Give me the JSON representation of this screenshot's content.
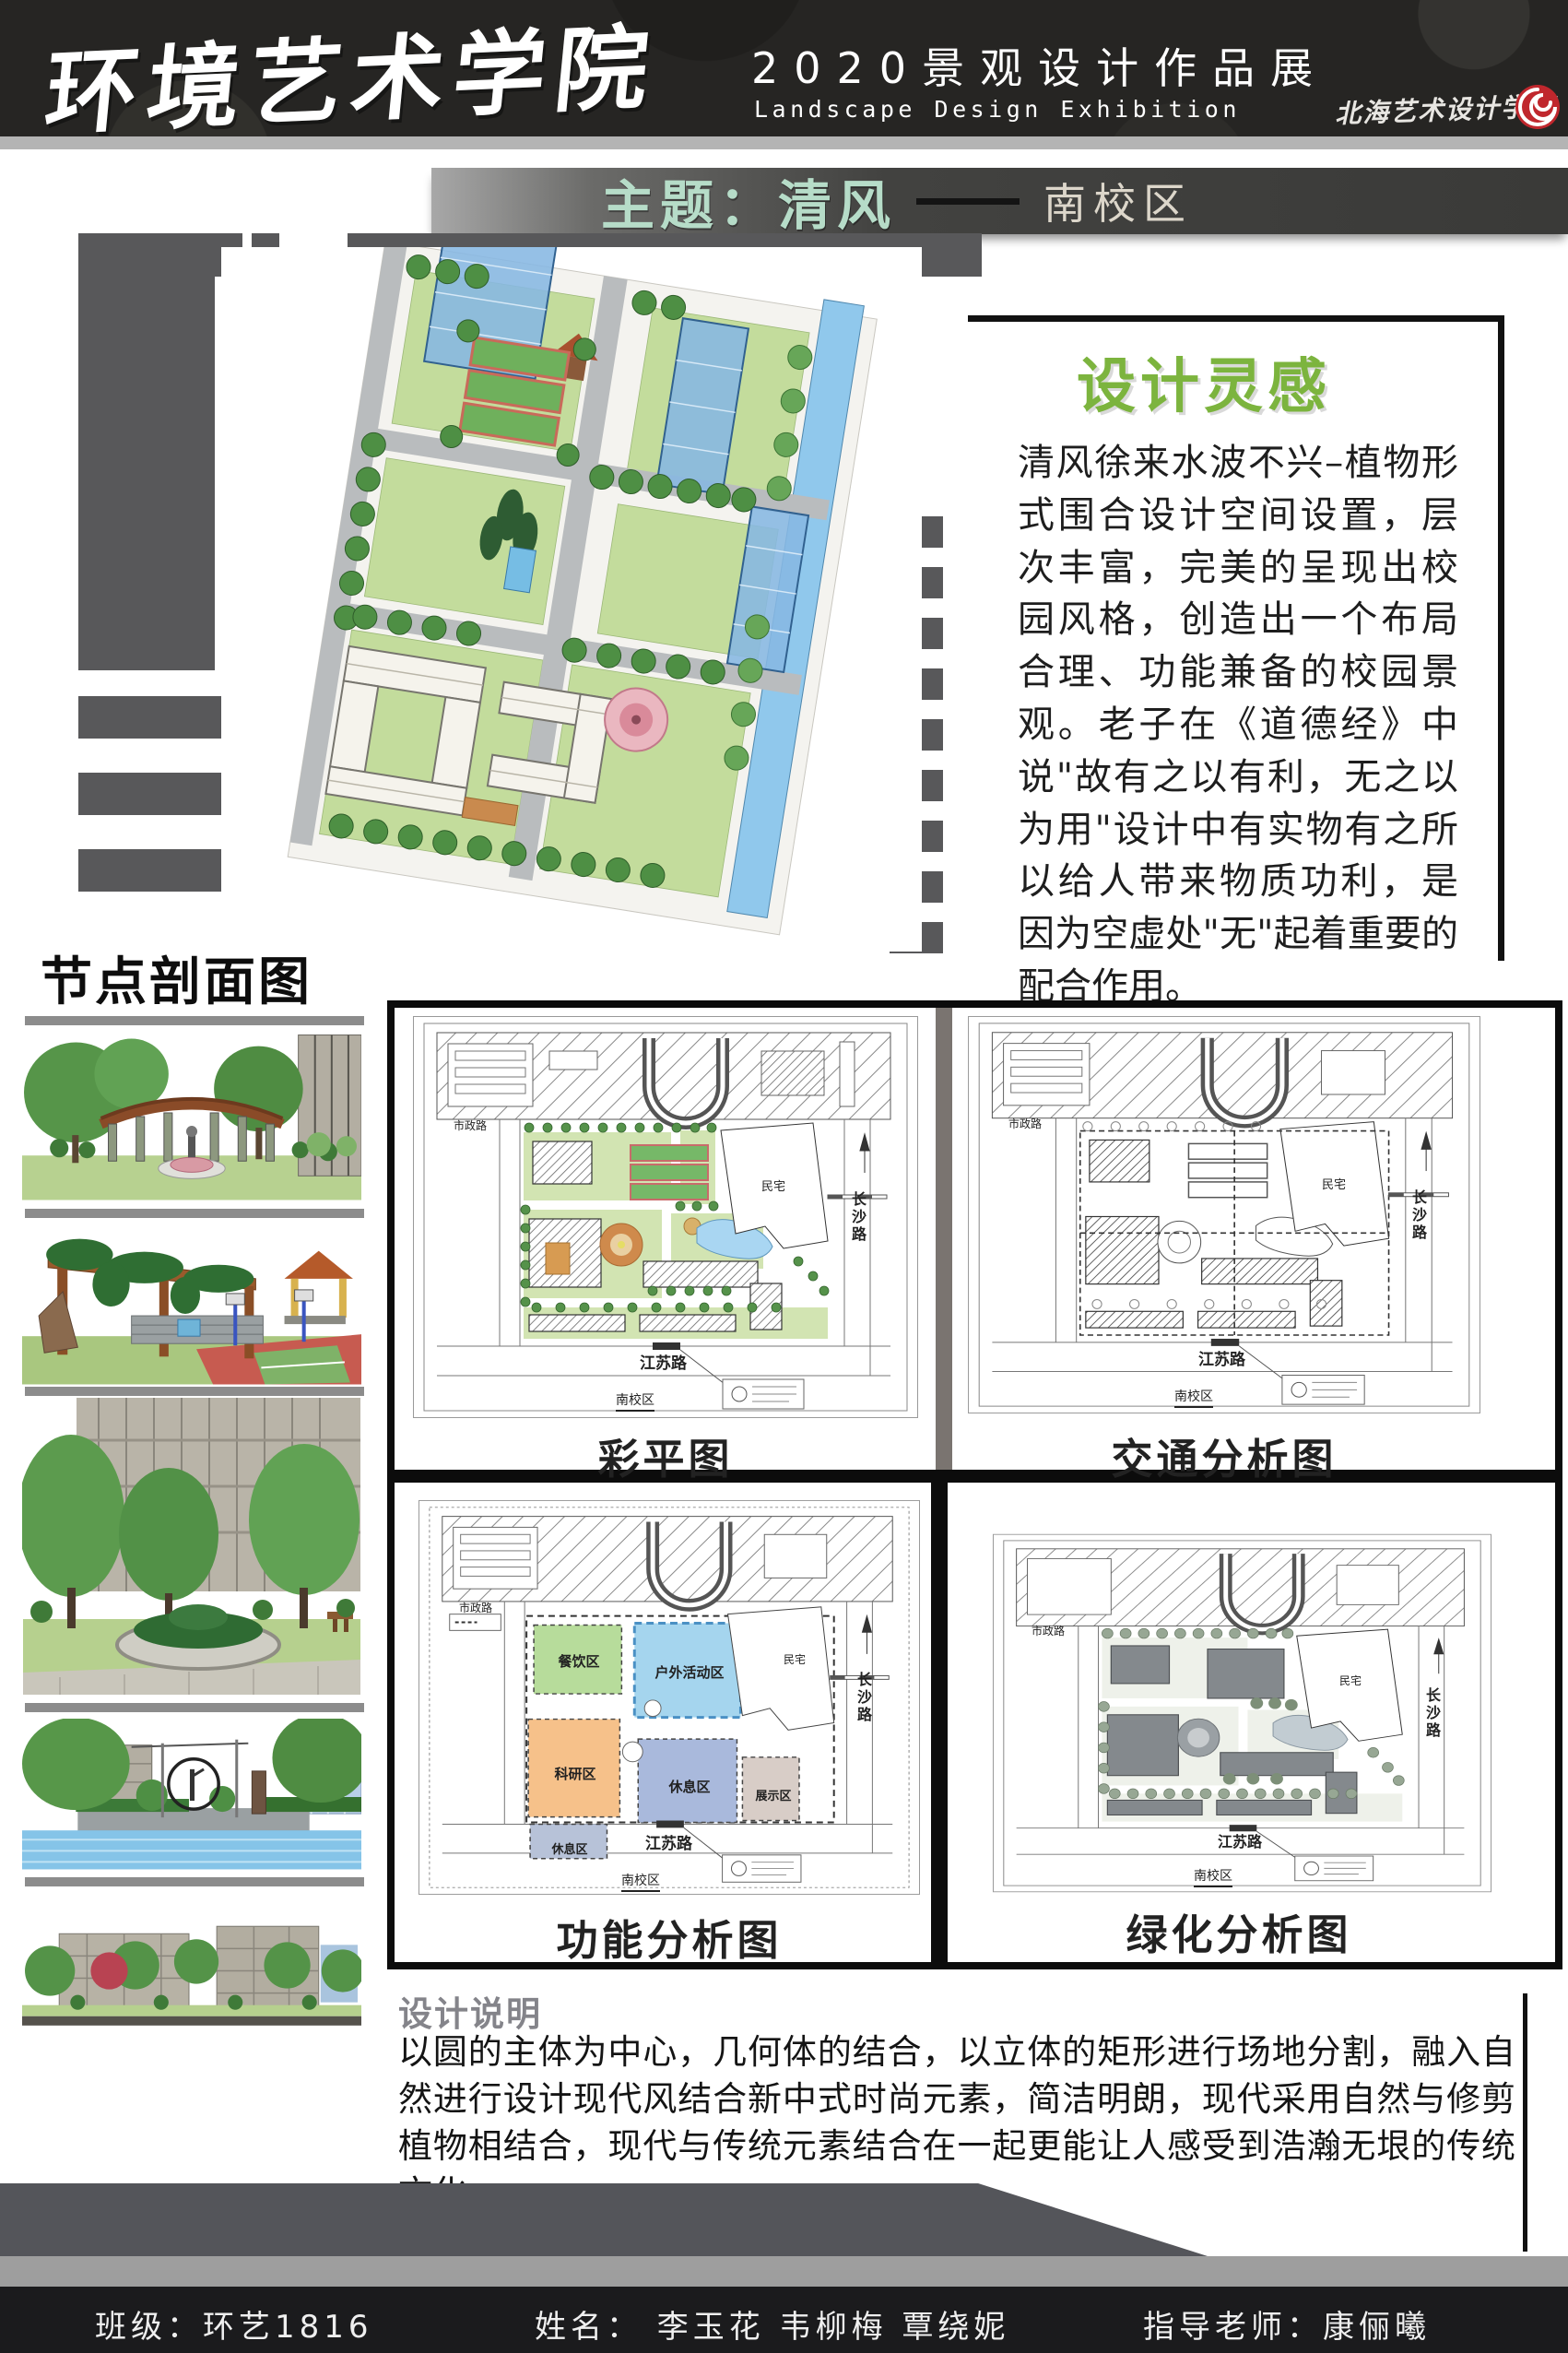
{
  "header": {
    "school": "环境艺术学院",
    "exh_cn": "2020景观设计作品展",
    "exh_en": "Landscape Design Exhibition",
    "logo_school": "北海艺术设计学院"
  },
  "banner": {
    "theme": "主题：清风",
    "campus": "南校区"
  },
  "inspiration": {
    "title": "设计灵感",
    "body": "清风徐来水波不兴–植物形式围合设计空间设置，层次丰富，完美的呈现出校园风格，创造出一个布局合理、功能兼备的校园景观。老子在《道德经》中说\"故有之以有利，无之以为用\"设计中有实物有之所以给人带来物质功利，是因为空虚处\"无\"起着重要的配合作用。"
  },
  "sections": {
    "node_title": "节点剖面图",
    "desc_title": "设计说明",
    "desc_body": "以圆的主体为中心，几何体的结合，以立体的矩形进行场地分割，融入自然进行设计现代风结合新中式时尚元素，简洁明朗，现代采用自然与修剪植物相结合，现代与传统元素结合在一起更能让人感受到浩瀚无垠的传统文化。"
  },
  "plans": {
    "titles": [
      "彩平图",
      "交通分析图",
      "功能分析图",
      "绿化分析图"
    ],
    "labels": {
      "road_top": "市政路",
      "road_right": "长沙路",
      "road_bottom": "江苏路",
      "site": "南校区",
      "residence": "民宅"
    },
    "zones": {
      "dining": "餐饮区",
      "outdoor": "户外活动区",
      "research": "科研区",
      "rest_a": "休息区",
      "rest_b": "休息区",
      "exhibit": "展示区"
    }
  },
  "footer": {
    "class_text": "班级：环艺1816",
    "names_text": "姓名：  李玉花  韦柳梅  覃绕妮",
    "advisor_text": "指导老师：康俪曦"
  },
  "colors": {
    "accent_green": "#7cb43e",
    "banner_mint": "#b6dcc8",
    "logo_red": "#c0272d"
  }
}
